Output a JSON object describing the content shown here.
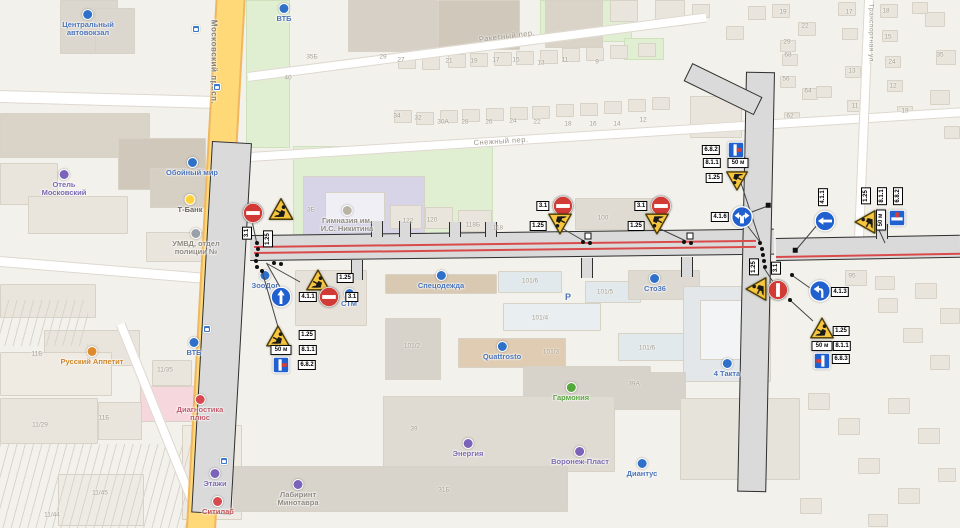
{
  "map": {
    "street_labels": [
      {
        "text": "Московский просп.",
        "x": 214,
        "y": 62,
        "rot": 90,
        "size": 8,
        "color": "#857f72",
        "bold": true
      },
      {
        "text": "Ракетный пер.",
        "x": 507,
        "y": 36,
        "rot": -7,
        "size": 7.5,
        "color": "#9b9589",
        "bold": false
      },
      {
        "text": "Снежный пер.",
        "x": 501,
        "y": 141,
        "rot": -3.5,
        "size": 7.5,
        "color": "#9b9589",
        "bold": false
      },
      {
        "text": "Транспортная ул.",
        "x": 871,
        "y": 34,
        "rot": 90,
        "size": 6.5,
        "color": "#9b9589",
        "bold": false
      }
    ],
    "house_numbers": [
      {
        "t": "29",
        "x": 383,
        "y": 57
      },
      {
        "t": "27",
        "x": 401,
        "y": 60
      },
      {
        "t": "21",
        "x": 449,
        "y": 61
      },
      {
        "t": "19",
        "x": 474,
        "y": 61
      },
      {
        "t": "17",
        "x": 496,
        "y": 60
      },
      {
        "t": "15",
        "x": 516,
        "y": 60
      },
      {
        "t": "13",
        "x": 541,
        "y": 63
      },
      {
        "t": "11",
        "x": 565,
        "y": 60
      },
      {
        "t": "9",
        "x": 597,
        "y": 62
      },
      {
        "t": "34",
        "x": 397,
        "y": 116
      },
      {
        "t": "32",
        "x": 418,
        "y": 118
      },
      {
        "t": "30А",
        "x": 443,
        "y": 122
      },
      {
        "t": "28",
        "x": 465,
        "y": 122
      },
      {
        "t": "26",
        "x": 489,
        "y": 122
      },
      {
        "t": "24",
        "x": 513,
        "y": 121
      },
      {
        "t": "22",
        "x": 537,
        "y": 122
      },
      {
        "t": "18",
        "x": 568,
        "y": 124
      },
      {
        "t": "16",
        "x": 593,
        "y": 124
      },
      {
        "t": "14",
        "x": 617,
        "y": 124
      },
      {
        "t": "12",
        "x": 643,
        "y": 120
      },
      {
        "t": "40",
        "x": 288,
        "y": 78
      },
      {
        "t": "35Б",
        "x": 312,
        "y": 57
      },
      {
        "t": "3Б",
        "x": 311,
        "y": 210
      },
      {
        "t": "122",
        "x": 408,
        "y": 221
      },
      {
        "t": "120",
        "x": 432,
        "y": 220
      },
      {
        "t": "118Б",
        "x": 473,
        "y": 225
      },
      {
        "t": "118",
        "x": 498,
        "y": 228
      },
      {
        "t": "100",
        "x": 603,
        "y": 218
      },
      {
        "t": "19",
        "x": 783,
        "y": 12
      },
      {
        "t": "22",
        "x": 805,
        "y": 26
      },
      {
        "t": "29",
        "x": 787,
        "y": 42
      },
      {
        "t": "68",
        "x": 788,
        "y": 55
      },
      {
        "t": "56",
        "x": 786,
        "y": 79
      },
      {
        "t": "64",
        "x": 808,
        "y": 91
      },
      {
        "t": "62",
        "x": 790,
        "y": 116
      },
      {
        "t": "17",
        "x": 849,
        "y": 12
      },
      {
        "t": "13",
        "x": 852,
        "y": 71
      },
      {
        "t": "11",
        "x": 855,
        "y": 106
      },
      {
        "t": "18",
        "x": 886,
        "y": 11
      },
      {
        "t": "15",
        "x": 888,
        "y": 37
      },
      {
        "t": "24",
        "x": 892,
        "y": 62
      },
      {
        "t": "12",
        "x": 893,
        "y": 86
      },
      {
        "t": "19",
        "x": 905,
        "y": 111
      },
      {
        "t": "35",
        "x": 940,
        "y": 55
      },
      {
        "t": "95",
        "x": 852,
        "y": 276
      },
      {
        "t": "101/6",
        "x": 530,
        "y": 281
      },
      {
        "t": "101/5",
        "x": 605,
        "y": 292
      },
      {
        "t": "101/4",
        "x": 540,
        "y": 318
      },
      {
        "t": "101/2",
        "x": 412,
        "y": 346
      },
      {
        "t": "101/3",
        "x": 551,
        "y": 352
      },
      {
        "t": "101/6",
        "x": 647,
        "y": 348
      },
      {
        "t": "39А",
        "x": 634,
        "y": 384
      },
      {
        "t": "39",
        "x": 414,
        "y": 429
      },
      {
        "t": "31Б",
        "x": 444,
        "y": 490
      },
      {
        "t": "11Б",
        "x": 37,
        "y": 354
      },
      {
        "t": "11/35",
        "x": 165,
        "y": 370
      },
      {
        "t": "11/29",
        "x": 40,
        "y": 425
      },
      {
        "t": "11Б",
        "x": 104,
        "y": 418
      },
      {
        "t": "11/45",
        "x": 100,
        "y": 493
      },
      {
        "t": "11/44",
        "x": 52,
        "y": 515
      }
    ],
    "pois": [
      {
        "lines": [
          "Центральный",
          "автовокзал"
        ],
        "x": 88,
        "y": 17,
        "icon": "#2f71c8",
        "color": "#4a73b8"
      },
      {
        "lines": [
          "ВТБ"
        ],
        "x": 284,
        "y": 7,
        "icon": "#2f71c8",
        "color": "#4a73b8"
      },
      {
        "lines": [
          "Обойный мир"
        ],
        "x": 192,
        "y": 161,
        "icon": "#2f71c8",
        "color": "#4a73b8"
      },
      {
        "lines": [
          "Отель",
          "Московский"
        ],
        "x": 64,
        "y": 177,
        "icon": "#7a63b8",
        "color": "#7a68b0"
      },
      {
        "lines": [
          "Т-Банк"
        ],
        "x": 190,
        "y": 198,
        "icon": "#ffd23c",
        "color": "#6b665e"
      },
      {
        "lines": [
          "УМВД, отдел",
          "полиции №"
        ],
        "x": 196,
        "y": 236,
        "icon": "#9aa0a8",
        "color": "#8d8880"
      },
      {
        "lines": [
          "Гимназия им.",
          "И.С. Никитина"
        ],
        "x": 347,
        "y": 213,
        "icon": "#b9b3a6",
        "color": "#8d8880"
      },
      {
        "lines": [
          "Спецодежда"
        ],
        "x": 441,
        "y": 274,
        "icon": "#2f71c8",
        "color": "#4a73b8"
      },
      {
        "lines": [
          "Сто36"
        ],
        "x": 655,
        "y": 277,
        "icon": "#2f71c8",
        "color": "#4a73b8"
      },
      {
        "lines": [
          "Quattrosto"
        ],
        "x": 502,
        "y": 345,
        "icon": "#2f71c8",
        "color": "#4a73b8"
      },
      {
        "lines": [
          "Гармония"
        ],
        "x": 571,
        "y": 386,
        "icon": "#53a83a",
        "color": "#57a33e"
      },
      {
        "lines": [
          "Энергия"
        ],
        "x": 468,
        "y": 442,
        "icon": "#7a63b8",
        "color": "#7a68b0"
      },
      {
        "lines": [
          "Воронеж-Пласт"
        ],
        "x": 580,
        "y": 450,
        "icon": "#7a63b8",
        "color": "#7a68b0"
      },
      {
        "lines": [
          "Диантус"
        ],
        "x": 642,
        "y": 462,
        "icon": "#2f71c8",
        "color": "#4a73b8"
      },
      {
        "lines": [
          "Русский Аппетит"
        ],
        "x": 92,
        "y": 350,
        "icon": "#e08a2e",
        "color": "#cf8427"
      },
      {
        "lines": [
          "ВТБ"
        ],
        "x": 194,
        "y": 341,
        "icon": "#2f71c8",
        "color": "#4a73b8"
      },
      {
        "lines": [
          "Диагностика",
          "плюс"
        ],
        "x": 200,
        "y": 402,
        "icon": "#d6494f",
        "color": "#c05a6b"
      },
      {
        "lines": [
          "Этажи"
        ],
        "x": 215,
        "y": 472,
        "icon": "#7a63b8",
        "color": "#7a68b0"
      },
      {
        "lines": [
          "Ситилаб"
        ],
        "x": 218,
        "y": 500,
        "icon": "#d6494f",
        "color": "#c0504f"
      },
      {
        "lines": [
          "4 Такта"
        ],
        "x": 727,
        "y": 362,
        "icon": "#2f71c8",
        "color": "#4a73b8"
      },
      {
        "lines": [
          "ЗооДог"
        ],
        "x": 265,
        "y": 274,
        "icon": "#2f71c8",
        "color": "#4a73b8"
      },
      {
        "lines": [
          "СТМ"
        ],
        "x": 349,
        "y": 292,
        "icon": "#2f71c8",
        "color": "#4a73b8"
      },
      {
        "lines": [
          "Лабиринт",
          "Минотавра"
        ],
        "x": 298,
        "y": 487,
        "icon": "#7a63b8",
        "color": "#8d8880"
      }
    ],
    "transit_stops": [
      [
        196,
        29
      ],
      [
        217,
        87
      ],
      [
        207,
        329
      ],
      [
        224,
        461
      ]
    ],
    "parking_marks": [
      {
        "t": "Р",
        "x": 568,
        "y": 297
      }
    ]
  },
  "closure": {
    "signs": [
      {
        "type": "no_entry",
        "code": "3.1",
        "x": 253,
        "y": 213,
        "s": 21,
        "lx": 247,
        "ly": 233,
        "lrot": 90
      },
      {
        "type": "roadworks",
        "code": "1.25",
        "x": 281,
        "y": 209,
        "s": 26,
        "lx": 268,
        "ly": 239,
        "lrot": 90
      },
      {
        "type": "roadworks",
        "code": "1.25",
        "x": 318,
        "y": 280,
        "s": 25,
        "lx": 345,
        "ly": 278,
        "lrot": 0
      },
      {
        "type": "go_straight",
        "code": "4.1.1",
        "x": 281,
        "y": 297,
        "s": 21,
        "lx": 308,
        "ly": 297,
        "lrot": 0
      },
      {
        "type": "no_entry",
        "code": "3.1",
        "x": 329,
        "y": 297,
        "s": 21,
        "lx": 352,
        "ly": 297,
        "lrot": 0
      },
      {
        "type": "roadworks",
        "code": "1.25",
        "x": 278,
        "y": 336,
        "s": 25,
        "lx": 307,
        "ly": 335,
        "lrot": 0
      },
      {
        "type": "plate50",
        "code": "8.1.1",
        "text": "50 м",
        "x": 281,
        "y": 350,
        "lx": 308,
        "ly": 350,
        "lrot": 0
      },
      {
        "type": "dead_end_right",
        "code": "6.8.2",
        "x": 281,
        "y": 365,
        "s": 17,
        "lx": 307,
        "ly": 365,
        "lrot": 0
      },
      {
        "type": "no_entry",
        "code": "3.1",
        "x": 563,
        "y": 206,
        "s": 21,
        "lx": 543,
        "ly": 206,
        "lrot": 0
      },
      {
        "type": "roadworks",
        "code": "1.25",
        "flip": true,
        "x": 560,
        "y": 224,
        "s": 25,
        "lx": 538,
        "ly": 226,
        "lrot": 0
      },
      {
        "type": "no_entry",
        "code": "3.1",
        "x": 661,
        "y": 206,
        "s": 21,
        "lx": 641,
        "ly": 206,
        "lrot": 0
      },
      {
        "type": "roadworks",
        "code": "1.25",
        "flip": true,
        "x": 657,
        "y": 224,
        "s": 25,
        "lx": 636,
        "ly": 226,
        "lrot": 0
      },
      {
        "type": "dead_end_right",
        "code": "6.8.2",
        "x": 736,
        "y": 150,
        "s": 17,
        "lx": 711,
        "ly": 150,
        "lrot": 0
      },
      {
        "type": "plate50",
        "code": "8.1.1",
        "text": "50 м",
        "x": 738,
        "y": 163,
        "lx": 712,
        "ly": 163,
        "lrot": 0
      },
      {
        "type": "roadworks",
        "code": "1.25",
        "flip": true,
        "x": 737,
        "y": 181,
        "s": 23,
        "lx": 714,
        "ly": 178,
        "lrot": 0
      },
      {
        "type": "left_right",
        "code": "4.1.6",
        "x": 742,
        "y": 217,
        "s": 22,
        "lx": 720,
        "ly": 217,
        "lrot": 0
      },
      {
        "type": "go_straight",
        "code": "4.1.1",
        "rot": -90,
        "x": 825,
        "y": 221,
        "s": 21,
        "lx": 823,
        "ly": 197,
        "lrot": 90
      },
      {
        "type": "roadworks",
        "code": "1.25",
        "rot": -90,
        "x": 865,
        "y": 222,
        "s": 25,
        "lx": 866,
        "ly": 196,
        "lrot": 90
      },
      {
        "type": "plate50",
        "code": "8.1.1",
        "text": "50 м",
        "rot": -90,
        "x": 881,
        "y": 220,
        "lx": 882,
        "ly": 196,
        "lrot": 90
      },
      {
        "type": "dead_end_right",
        "code": "6.8.2",
        "rot": -90,
        "x": 897,
        "y": 218,
        "s": 17,
        "lx": 898,
        "ly": 196,
        "lrot": 90
      },
      {
        "type": "roadworks",
        "code": "1.25",
        "rot": -90,
        "x": 756,
        "y": 289,
        "s": 25,
        "lx": 754,
        "ly": 267,
        "lrot": 90
      },
      {
        "type": "no_entry",
        "code": "3.1",
        "rot": -90,
        "x": 778,
        "y": 290,
        "s": 21,
        "lx": 776,
        "ly": 268,
        "lrot": 90
      },
      {
        "type": "turn_left",
        "code": "4.1.3",
        "x": 820,
        "y": 291,
        "s": 22,
        "lx": 840,
        "ly": 292,
        "lrot": 0
      },
      {
        "type": "roadworks",
        "code": "1.25",
        "x": 822,
        "y": 328,
        "s": 25,
        "lx": 841,
        "ly": 331,
        "lrot": 0
      },
      {
        "type": "plate50",
        "code": "8.1.1",
        "text": "50 м",
        "x": 822,
        "y": 346,
        "lx": 842,
        "ly": 346,
        "lrot": 0
      },
      {
        "type": "dead_end_left",
        "code": "6.8.3",
        "x": 822,
        "y": 361,
        "s": 17,
        "lx": 841,
        "ly": 359,
        "lrot": 0
      }
    ],
    "dots": [
      [
        257,
        243
      ],
      [
        258,
        249
      ],
      [
        257,
        255
      ],
      [
        256,
        261
      ],
      [
        257,
        267
      ],
      [
        274,
        263
      ],
      [
        281,
        264
      ],
      [
        262,
        271
      ],
      [
        583,
        242
      ],
      [
        590,
        243
      ],
      [
        684,
        242
      ],
      [
        691,
        243
      ],
      [
        760,
        243
      ],
      [
        762,
        249
      ],
      [
        763,
        255
      ],
      [
        764,
        261
      ],
      [
        765,
        267
      ],
      [
        757,
        272
      ],
      [
        790,
        300
      ],
      [
        792,
        275
      ]
    ],
    "white_squares": [
      [
        588,
        236
      ],
      [
        690,
        236
      ]
    ],
    "black_squares": [
      [
        795,
        250
      ],
      [
        768,
        205
      ]
    ],
    "leader_lines": [
      [
        252,
        221,
        257,
        244
      ],
      [
        300,
        282,
        266,
        263
      ],
      [
        284,
        294,
        267,
        264
      ],
      [
        262,
        271,
        278,
        327
      ],
      [
        560,
        227,
        584,
        241
      ],
      [
        656,
        227,
        686,
        241
      ],
      [
        740,
        180,
        760,
        241
      ],
      [
        749,
        213,
        768,
        206
      ],
      [
        746,
        224,
        760,
        242
      ],
      [
        818,
        224,
        796,
        250
      ],
      [
        779,
        291,
        764,
        268
      ],
      [
        810,
        288,
        793,
        276
      ],
      [
        813,
        321,
        791,
        301
      ],
      [
        879,
        230,
        885,
        243
      ]
    ]
  }
}
